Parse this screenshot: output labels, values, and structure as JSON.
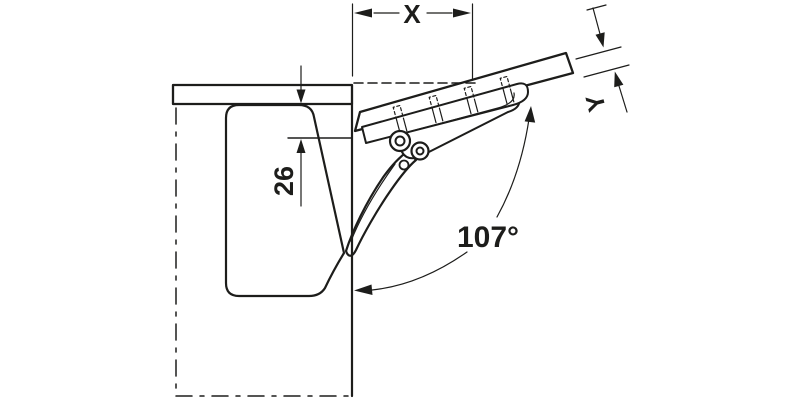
{
  "diagram": {
    "labels": {
      "overhang_dimension": "X",
      "flap_thickness_dimension": "Y",
      "top_panel_offset": "26",
      "opening_angle": "107°"
    },
    "colors": {
      "line": "#1d1d1b",
      "background": "#ffffff"
    }
  }
}
